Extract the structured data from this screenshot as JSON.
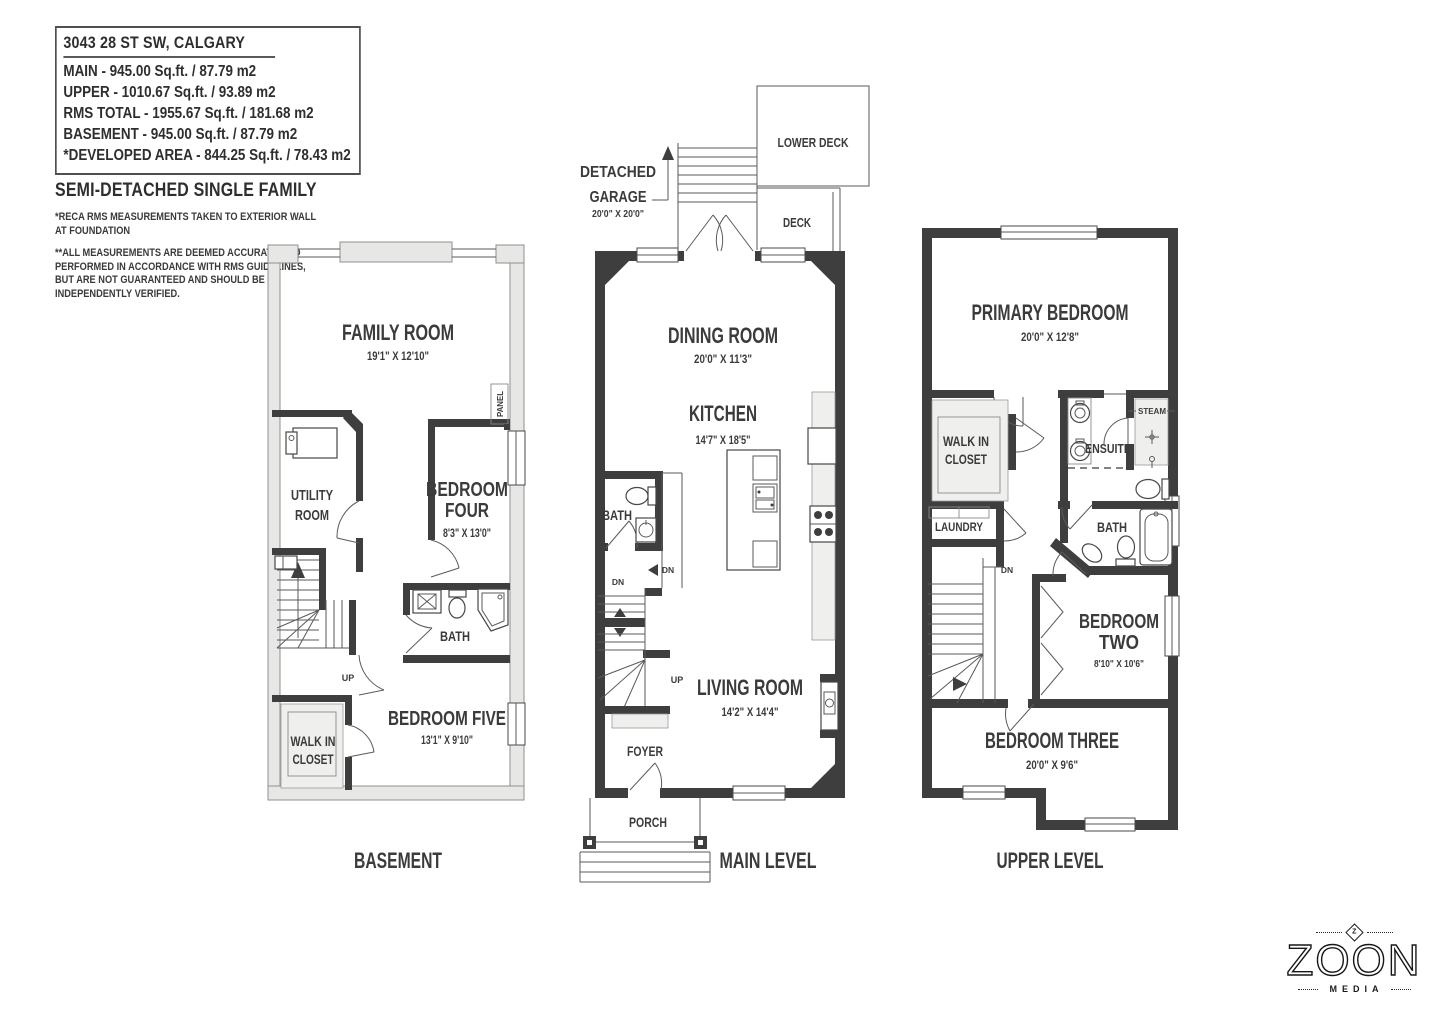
{
  "info_box": {
    "address": "3043 28 ST SW, CALGARY",
    "line1": "MAIN - 945.00 Sq.ft. / 87.79 m2",
    "line2": "UPPER - 1010.67 Sq.ft. / 93.89 m2",
    "line3": "RMS TOTAL - 1955.67 Sq.ft. / 181.68 m2",
    "line4": "BASEMENT - 945.00 Sq.ft. / 87.79 m2",
    "line5": "*DEVELOPED AREA - 844.25 Sq.ft. / 78.43 m2",
    "property_type": "SEMI-DETACHED SINGLE FAMILY",
    "note1": "*RECA RMS MEASUREMENTS TAKEN TO EXTERIOR WALL\nAT FOUNDATION",
    "note2": "**ALL MEASUREMENTS ARE DEEMED ACCURATE AND\nPERFORMED IN ACCORDANCE WITH RMS GUIDELINES,\nBUT ARE NOT GUARANTEED AND SHOULD BE\nINDEPENDENTLY VERIFIED."
  },
  "basement": {
    "title": "BASEMENT",
    "labels": {
      "family_room": "FAMILY ROOM",
      "family_room_dim": "19'1\" X 12'10\"",
      "utility_l1": "UTILITY",
      "utility_l2": "ROOM",
      "bedroom_four_l1": "BEDROOM",
      "bedroom_four_l2": "FOUR",
      "bedroom_four_dim": "8'3\" X 13'0\"",
      "bath": "BATH",
      "bedroom_five": "BEDROOM FIVE",
      "bedroom_five_dim": "13'1\" X 9'10\"",
      "walk_in_l1": "WALK IN",
      "walk_in_l2": "CLOSET",
      "panel": "PANEL",
      "up": "UP"
    }
  },
  "main": {
    "title": "MAIN LEVEL",
    "labels": {
      "detached_l1": "DETACHED",
      "detached_l2": "GARAGE",
      "garage_dim": "20'0\" X 20'0\"",
      "lower_deck": "LOWER DECK",
      "deck": "DECK",
      "dining_room": "DINING ROOM",
      "dining_room_dim": "20'0\" X 11'3\"",
      "kitchen": "KITCHEN",
      "kitchen_dim": "14'7\" X 18'5\"",
      "bath": "BATH",
      "living_room": "LIVING ROOM",
      "living_room_dim": "14'2\" X 14'4\"",
      "foyer": "FOYER",
      "porch": "PORCH",
      "dn": "DN",
      "up": "UP"
    }
  },
  "upper": {
    "title": "UPPER LEVEL",
    "labels": {
      "primary_bedroom": "PRIMARY BEDROOM",
      "primary_bedroom_dim": "20'0\" X 12'8\"",
      "walk_in_l1": "WALK IN",
      "walk_in_l2": "CLOSET",
      "ensuite": "ENSUITE",
      "steam": "STEAM",
      "laundry": "LAUNDRY",
      "bath": "BATH",
      "bedroom_two_l1": "BEDROOM",
      "bedroom_two_l2": "TWO",
      "bedroom_two_dim": "8'10\" X 10'6\"",
      "bedroom_three": "BEDROOM THREE",
      "bedroom_three_dim": "20'0\" X 9'6\"",
      "dn": "DN"
    }
  },
  "logo": {
    "z": "Z",
    "name": "ZOON",
    "media": "MEDIA"
  },
  "colors": {
    "wall": "#3e3e3e",
    "foundation": "#e7e7e6",
    "text": "#3b3b3b"
  }
}
